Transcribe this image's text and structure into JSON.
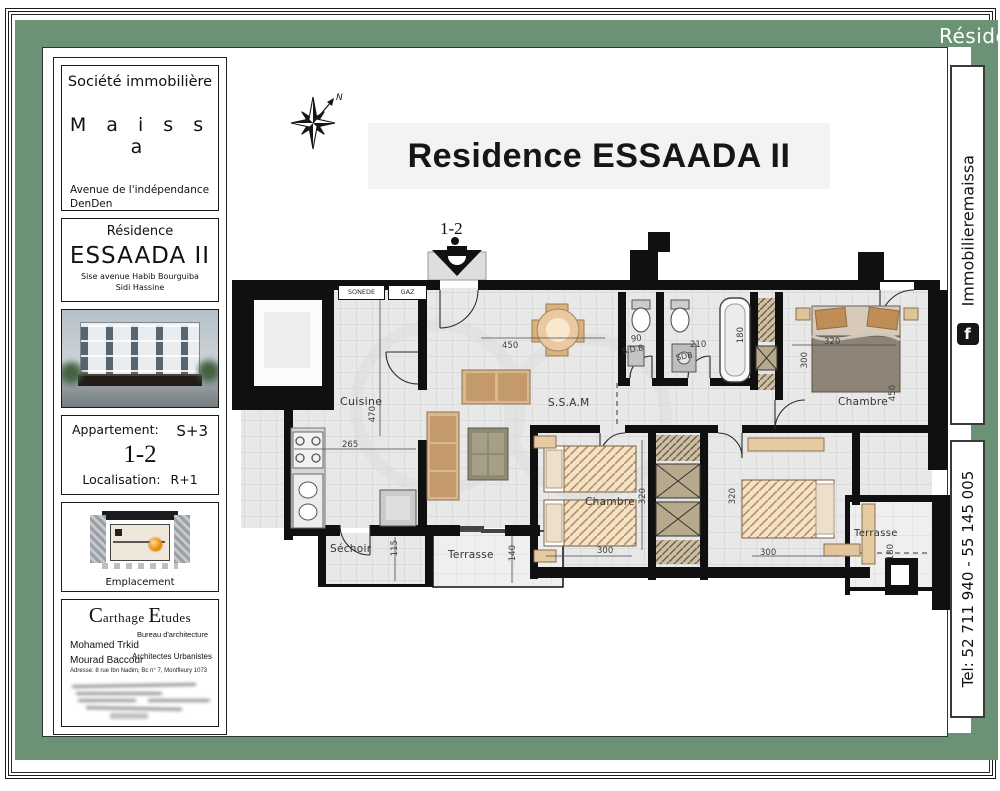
{
  "banner": {
    "text": "Résidence"
  },
  "title": "Residence ESSAADA II",
  "compass": {
    "n": "N"
  },
  "left": {
    "company": {
      "heading": "Société immobilière",
      "name": "M a i s s a",
      "address1": "Avenue de l'indépendance",
      "address2": "DenDen"
    },
    "residence": {
      "heading": "Résidence",
      "name": "ESSAADA II",
      "address1": "Sise avenue Habib Bourguiba",
      "address2": "Sidi Hassine"
    },
    "apartment": {
      "label": "Appartement:",
      "type": "S+3",
      "unit": "1-2",
      "loc_label": "Localisation:",
      "loc_value": "R+1"
    },
    "emplacement": {
      "caption": "Emplacement"
    },
    "studio": {
      "c1": "C",
      "w1": "arthage ",
      "c2": "E",
      "w2": "tudes",
      "subtitle": "Bureau d'architecture",
      "architect1": "Mohamed Trkid",
      "architect2": "Mourad Baccour",
      "role": "Architectes Urbanistes",
      "address": "Adresse: 8 rue Ibn Nadim, Bc n° 7, Montfleury 1073"
    }
  },
  "sidebar": {
    "brand": "Immobilieremaissa",
    "facebook": "f",
    "tel": "Tel: 52 711 940 - 55 145 005"
  },
  "plan": {
    "entrance": "1-2",
    "sonede": "SONEDE",
    "gaz": "GAZ",
    "rooms": {
      "cuisine": "Cuisine",
      "ssam": "S.S.A.M",
      "sdb1": "S.D.B",
      "sdb2": "SDB",
      "chambre1": "Chambre",
      "chambre2": "Chambre",
      "sechoir": "Séchoir",
      "terrasse1": "Terrasse",
      "terrasse2": "Terrasse"
    },
    "dims": {
      "cuisine_w": "265",
      "cuisine_h": "470",
      "ssam_w": "450",
      "sdb1_w": "90",
      "sdb2_w": "210",
      "tub_l": "180",
      "ch1_w": "320",
      "ch1_d": "300",
      "ch1_h": "450",
      "sechoir_h": "115",
      "terrasse1_h": "140",
      "ch2_h": "320",
      "ch2_w": "300",
      "ch3_h": "320",
      "ch3_w": "300",
      "terrasse2_h": "180"
    }
  },
  "colors": {
    "frame_green": "#6b9274",
    "accent_orange": "#f08c00"
  }
}
